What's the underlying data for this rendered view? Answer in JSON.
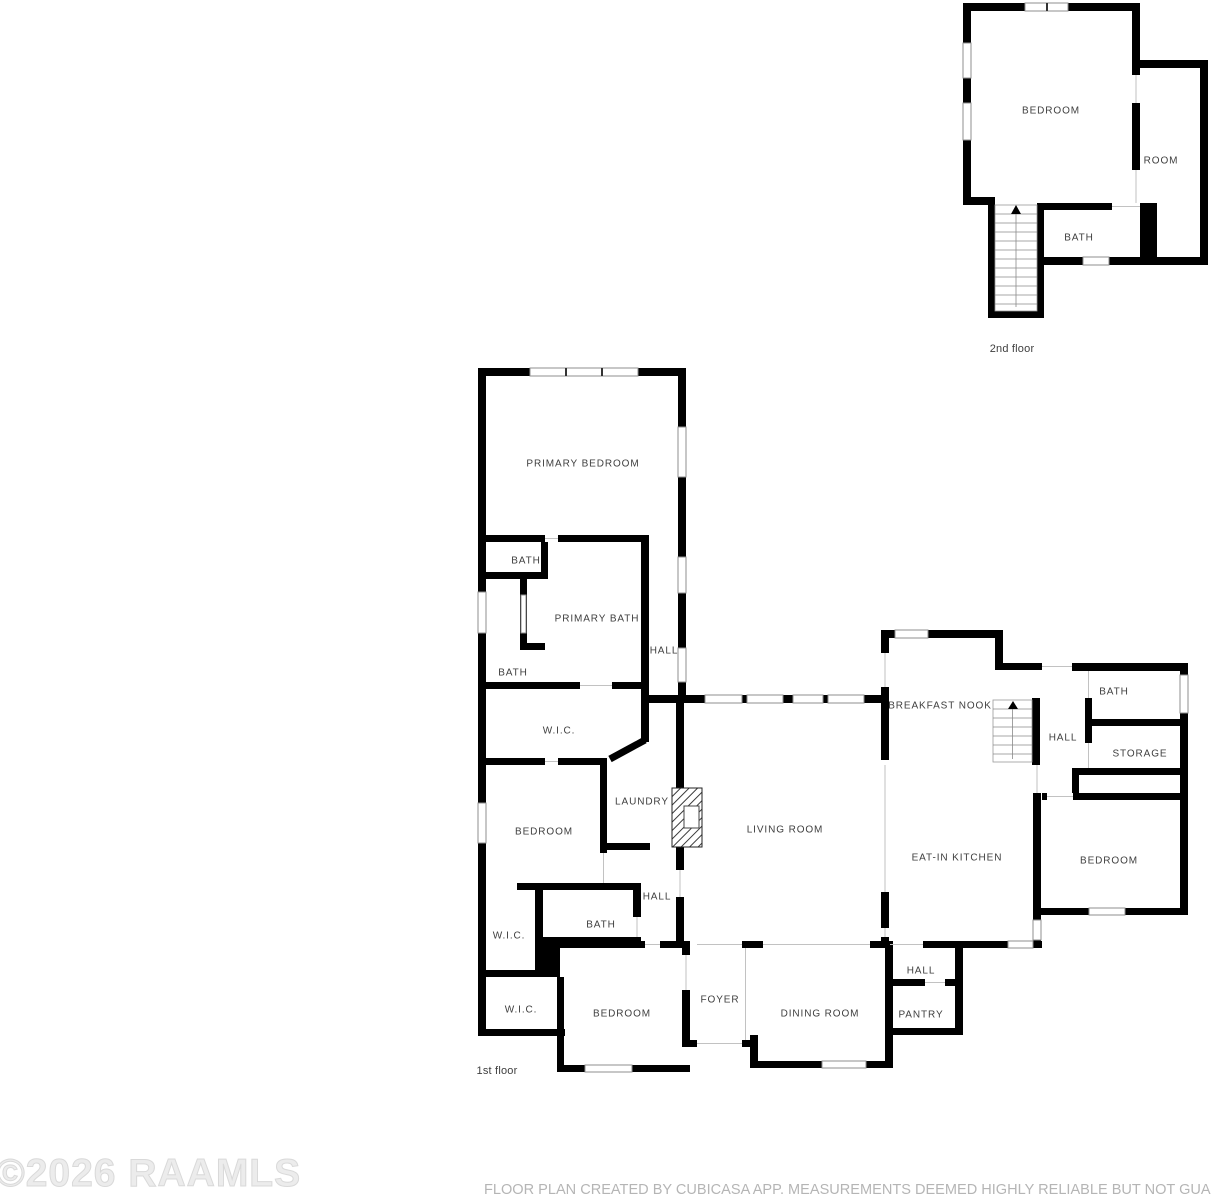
{
  "page": {
    "watermark": "©2026 RAAMLS",
    "disclaimer": "FLOOR PLAN CREATED BY CUBICASA APP. MEASUREMENTS DEEMED HIGHLY RELIABLE BUT NOT GUARANTEED."
  },
  "colors": {
    "wall": "#000000",
    "label": "#3e3e3e",
    "window_stroke": "#8f8f8f",
    "opening_line": "#c2c2c2",
    "watermark": "#e5e5e5",
    "disclaimer": "#b5b5b5"
  },
  "floors": [
    {
      "name": "2nd floor",
      "label": {
        "text": "2nd floor",
        "x": 1012,
        "y": 349
      },
      "rooms": [
        {
          "label": "BEDROOM",
          "x": 1051,
          "y": 111
        },
        {
          "label": "ROOM",
          "x": 1161,
          "y": 161
        },
        {
          "label": "BATH",
          "x": 1079,
          "y": 238
        }
      ]
    },
    {
      "name": "1st floor",
      "label": {
        "text": "1st floor",
        "x": 497,
        "y": 1071
      },
      "rooms": [
        {
          "label": "PRIMARY BEDROOM",
          "x": 583,
          "y": 464
        },
        {
          "label": "BATH",
          "x": 526,
          "y": 561
        },
        {
          "label": "PRIMARY BATH",
          "x": 597,
          "y": 619
        },
        {
          "label": "HALL",
          "x": 664,
          "y": 651
        },
        {
          "label": "BATH",
          "x": 513,
          "y": 673
        },
        {
          "label": "W.I.C.",
          "x": 559,
          "y": 731
        },
        {
          "label": "LAUNDRY",
          "x": 642,
          "y": 802
        },
        {
          "label": "BEDROOM",
          "x": 544,
          "y": 832
        },
        {
          "label": "LIVING ROOM",
          "x": 785,
          "y": 830
        },
        {
          "label": "BREAKFAST NOOK",
          "x": 940,
          "y": 706
        },
        {
          "label": "EAT-IN KITCHEN",
          "x": 957,
          "y": 858
        },
        {
          "label": "BATH",
          "x": 1114,
          "y": 692
        },
        {
          "label": "HALL",
          "x": 1063,
          "y": 738
        },
        {
          "label": "STORAGE",
          "x": 1140,
          "y": 754
        },
        {
          "label": "BEDROOM",
          "x": 1109,
          "y": 861
        },
        {
          "label": "HALL",
          "x": 657,
          "y": 897
        },
        {
          "label": "BATH",
          "x": 601,
          "y": 925
        },
        {
          "label": "W.I.C.",
          "x": 509,
          "y": 936
        },
        {
          "label": "W.I.C.",
          "x": 521,
          "y": 1010
        },
        {
          "label": "BEDROOM",
          "x": 622,
          "y": 1014
        },
        {
          "label": "FOYER",
          "x": 720,
          "y": 1000
        },
        {
          "label": "DINING ROOM",
          "x": 820,
          "y": 1014
        },
        {
          "label": "HALL",
          "x": 921,
          "y": 971
        },
        {
          "label": "PANTRY",
          "x": 921,
          "y": 1015
        }
      ]
    }
  ]
}
